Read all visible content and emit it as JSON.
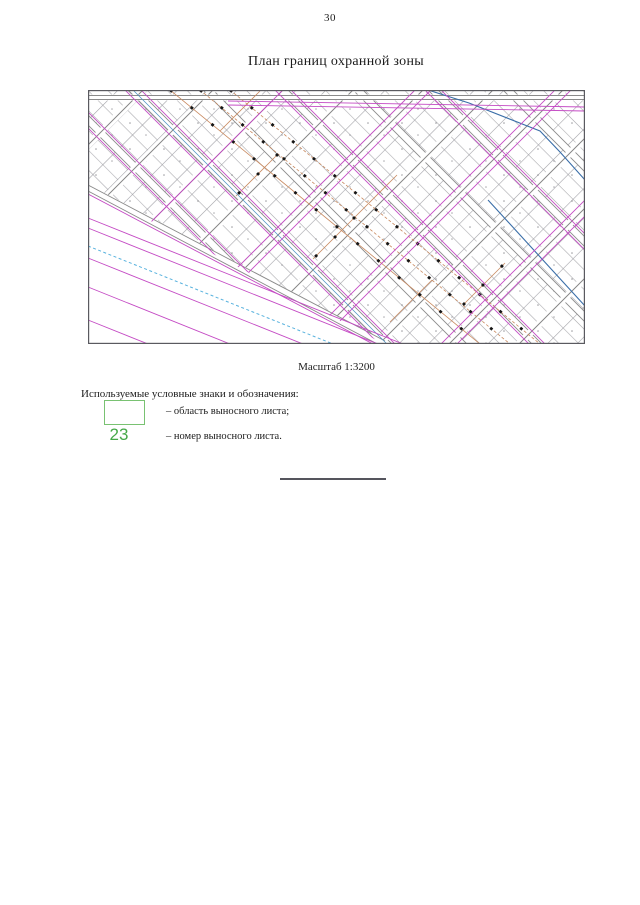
{
  "page": {
    "number": "30",
    "title": "План границ охранной зоны"
  },
  "map": {
    "caption": "Масштаб 1:3200"
  },
  "legend": {
    "heading": "Используемые условные знаки и обозначения:",
    "items": [
      {
        "symbol": "green-outline-rectangle",
        "label": "– область выносного листа;"
      },
      {
        "symbol": "23",
        "label": "– номер выносного листа."
      }
    ]
  },
  "colors": {
    "legend_green": "#45a848",
    "legend_rect_green": "#79c272",
    "zone_magenta": "#c44ac4",
    "water_cyan": "#58b2de",
    "power_orange": "#c8895f",
    "street_gray": "#8a8a8a",
    "cable_blue": "#3a6ea8"
  }
}
